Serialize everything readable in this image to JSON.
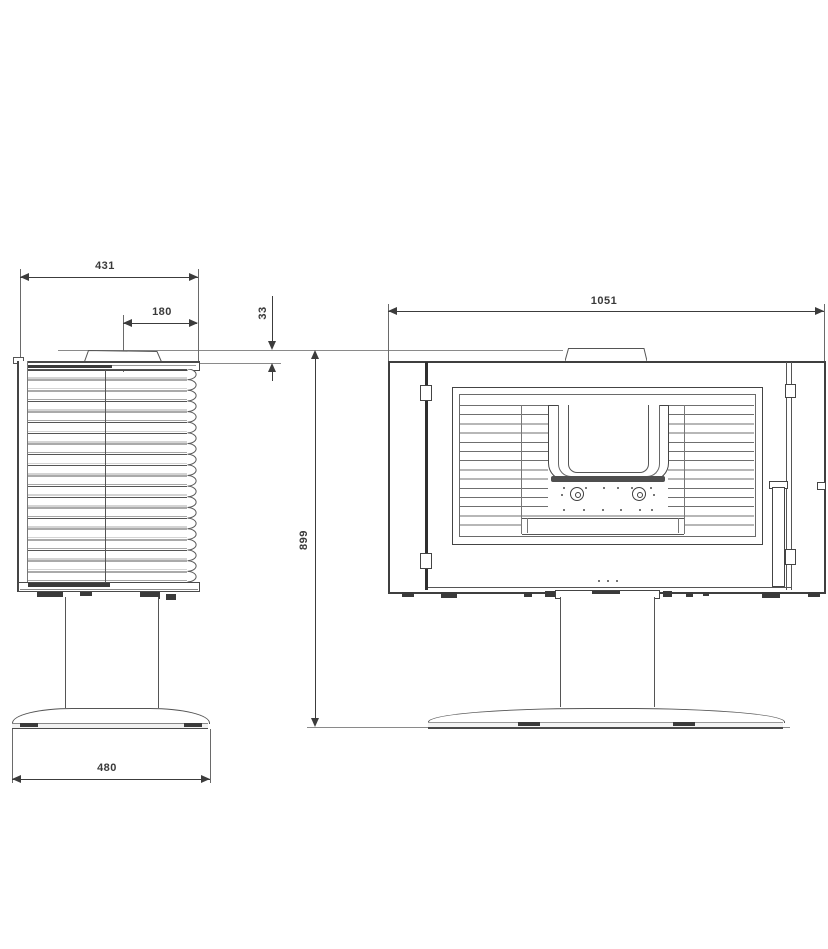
{
  "side_view": {
    "depth_label": "431",
    "flue_offset_label": "180",
    "collar_height_label": "33",
    "base_depth_label": "480"
  },
  "front_view": {
    "width_label": "1051",
    "height_label": "899"
  },
  "colors": {
    "ink": "#3c3c3c",
    "thin_line": "#8a8a8a",
    "background": "#ffffff"
  }
}
